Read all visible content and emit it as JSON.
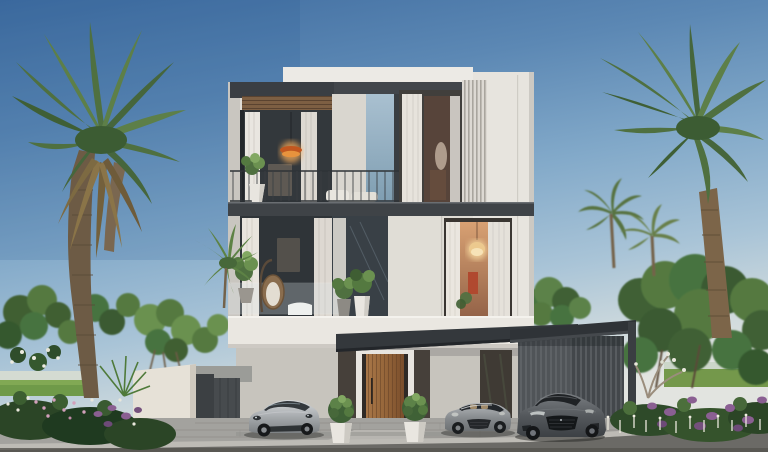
{
  "scene": {
    "type": "architectural-exterior-rendering",
    "setting": "modern luxury villa, clear daylight sky",
    "aria_label": "Photorealistic rendering of a modern white three-storey villa flanked by tall palm trees, with flowering garden beds, a slatted carport and three sports cars parked on a paved driveway"
  },
  "villa": {
    "storeys": 3,
    "features": [
      "white parapet roof",
      "dark roof fascia with timber soffit",
      "vertical slatted fins",
      "top-floor balcony with metal railing",
      "second-floor glass balustrade",
      "hanging egg chair",
      "warm pendant lamp",
      "crystal chandelier",
      "timber slatted entrance door",
      "dark entrance canopy",
      "slatted carport wall"
    ]
  },
  "cars": [
    {
      "name": "silver-sports-coupe",
      "body_color": "#b7babd",
      "position": "left of entrance"
    },
    {
      "name": "grey-roadster-convertible",
      "body_color": "#9a9ea1",
      "position": "right of entrance"
    },
    {
      "name": "graphite-sports-coupe",
      "body_color": "#54585c",
      "position": "under carport"
    }
  ],
  "vegetation": {
    "left": [
      "tall date palm with double trunk and dried brown skirt",
      "leafy trees",
      "white plumeria flowers",
      "pink and purple flower bed",
      "fan palm"
    ],
    "right": [
      "tall coconut palm",
      "two midground palms",
      "broad tree canopy",
      "plumeria shrub",
      "purple salvia bed",
      "white flower spikes"
    ],
    "center": [
      "two topiary balls in white pots",
      "balcony planters"
    ]
  },
  "palette": {
    "sky_top": "#3e6b9f",
    "sky_mid": "#82a9c9",
    "sky_horizon": "#e2e4e0",
    "wall_white": "#e7e4de",
    "band_white": "#eae7e1",
    "stucco": "#d9d6cf",
    "ground_wall": "#c7c4bd",
    "slab_dark": "#3f4347",
    "canopy_dark": "#34383c",
    "carport_roof": "#2f3337",
    "carport_slats": "#43474b",
    "soffit_wood": "#7d5f43",
    "door_wood": "#9c6b3e",
    "glass_dark": "#2f3438",
    "warm_light": "#eca95f",
    "leaf_dark": "#35532c",
    "leaf_mid": "#4f7040",
    "leaf_light": "#6b9150",
    "palm_dry": "#8a7448",
    "flower_purple": "#8a5f92",
    "flower_pink": "#d2a0bb",
    "flower_white": "#e9e7dc",
    "driveway": "#a3a29e",
    "road": "#6b6a66",
    "curb": "#bdbbb5",
    "boundary_wall": "#e6e1d7"
  }
}
